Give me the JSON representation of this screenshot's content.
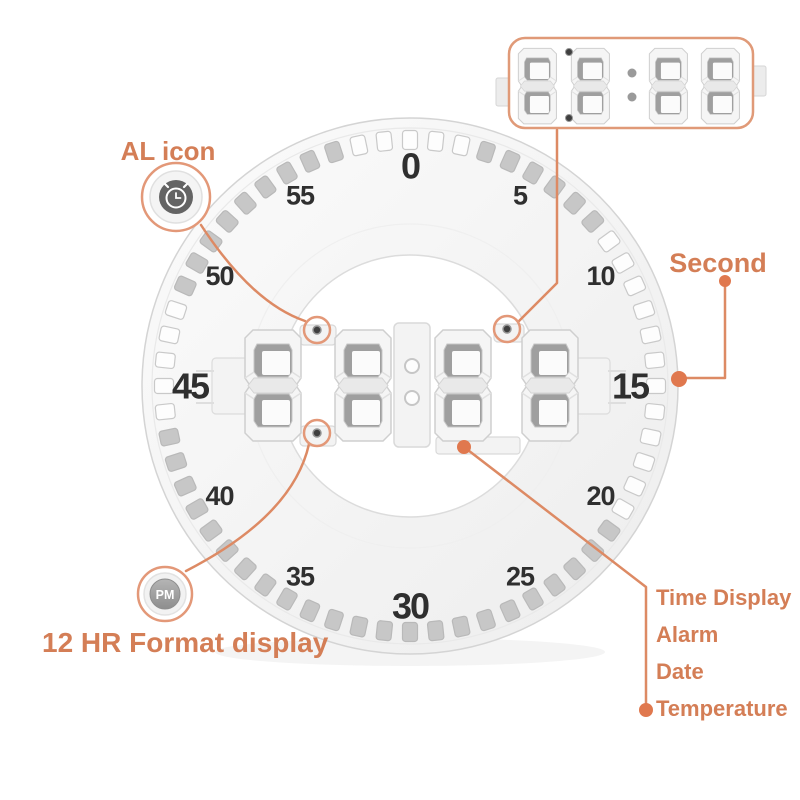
{
  "clock": {
    "display_value": "88:88",
    "tick_count": 60,
    "numbers": [
      {
        "label": "0",
        "minute": 0,
        "major": true
      },
      {
        "label": "5",
        "minute": 5,
        "major": false
      },
      {
        "label": "10",
        "minute": 10,
        "major": false
      },
      {
        "label": "15",
        "minute": 15,
        "major": true
      },
      {
        "label": "20",
        "minute": 20,
        "major": false
      },
      {
        "label": "25",
        "minute": 25,
        "major": false
      },
      {
        "label": "30",
        "minute": 30,
        "major": true
      },
      {
        "label": "35",
        "minute": 35,
        "major": false
      },
      {
        "label": "40",
        "minute": 40,
        "major": false
      },
      {
        "label": "45",
        "minute": 45,
        "major": true
      },
      {
        "label": "50",
        "minute": 50,
        "major": false
      },
      {
        "label": "55",
        "minute": 55,
        "major": false
      }
    ]
  },
  "inset": {
    "display_value": "88:88"
  },
  "annotations": {
    "al_icon": {
      "label": "AL icon"
    },
    "pm_badge": {
      "label": "PM"
    },
    "format_display": {
      "label": "12 HR Format display"
    },
    "second": {
      "label": "Second"
    },
    "features": {
      "items": [
        "Time Display",
        "Alarm",
        "Date",
        "Temperature"
      ]
    }
  },
  "colors": {
    "accent_text": "#d47e56",
    "accent_line": "#dd8a64",
    "accent_dot": "#e0784e",
    "number_color": "#2f2f2f",
    "clock_body": "#f6f6f6",
    "tick_gray": "#c7c7c7"
  }
}
